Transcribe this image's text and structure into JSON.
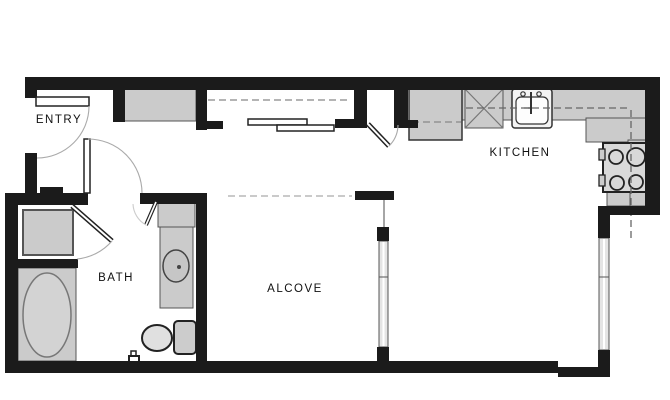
{
  "floorplan": {
    "rooms": [
      {
        "name": "entry",
        "label": "ENTRY"
      },
      {
        "name": "bath",
        "label": "BATH"
      },
      {
        "name": "alcove",
        "label": "ALCOVE"
      },
      {
        "name": "kitchen",
        "label": "KITCHEN"
      }
    ],
    "fixtures": [
      "entry-closet",
      "sliding-closet-doors",
      "refrigerator",
      "dishwasher",
      "kitchen-sink",
      "range",
      "washer",
      "bathtub",
      "vanity",
      "vanity-sink",
      "toilet",
      "alcove-window",
      "right-window"
    ],
    "colors": {
      "background": "#ffffff",
      "wall": "#1b1b1b",
      "fixture_fill": "#cbcbcb",
      "fixture_stroke": "#555555",
      "window_fill": "#e4e4e4",
      "door_arc": "#aaaaaa",
      "dashed_line": "#888888",
      "label_color": "#111111"
    }
  }
}
